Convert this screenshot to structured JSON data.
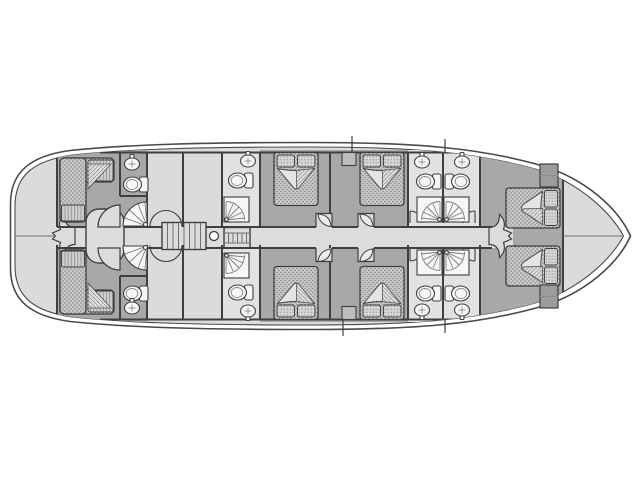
{
  "diagram": {
    "kind": "yacht-lower-deck-floor-plan",
    "orientation": {
      "bow": "right",
      "stern": "left",
      "port_side": "top",
      "starboard_side": "bottom"
    }
  },
  "colors": {
    "background": "#ffffff",
    "hull_ring": "#ffffff",
    "hull_line": "#4a4a4a",
    "interior": "#dbdbdb",
    "cabin_floor": "#a8a8a8",
    "corridor_floor": "#dcdcdc",
    "bathroom_floor": "#e2e2e2",
    "wall_line": "#3f3f3f",
    "fixture_fill": "#f6f6f6",
    "bed_base": "#c8c8c8",
    "wardrobe_fill": "#9c9c9c"
  },
  "rooms": [
    {
      "name": "stern-compartment",
      "type": "storage",
      "fixtures": []
    },
    {
      "name": "aft-cabin-port",
      "type": "cabin",
      "fixtures": [
        "l-shaped-sofa-bed",
        "washbasin",
        "toilet",
        "corner-shower",
        "entry-door"
      ]
    },
    {
      "name": "aft-cabin-starboard",
      "type": "cabin",
      "fixtures": [
        "l-shaped-sofa-bed",
        "washbasin",
        "toilet",
        "corner-shower",
        "entry-door"
      ]
    },
    {
      "name": "companionway",
      "type": "circulation",
      "fixtures": [
        "staircase",
        "steps",
        "mast",
        "double-door-aft",
        "double-door-forward",
        "corridor"
      ]
    },
    {
      "name": "guest-cabin-port-aft",
      "type": "cabin",
      "fixtures": [
        "double-bed",
        "entry-door"
      ]
    },
    {
      "name": "guest-cabin-port-forward",
      "type": "cabin",
      "fixtures": [
        "double-bed",
        "cabinet",
        "entry-door"
      ]
    },
    {
      "name": "guest-cabin-starboard-aft",
      "type": "cabin",
      "fixtures": [
        "double-bed",
        "entry-door"
      ]
    },
    {
      "name": "guest-cabin-starboard-forward",
      "type": "cabin",
      "fixtures": [
        "double-bed",
        "cabinet",
        "entry-door"
      ]
    },
    {
      "name": "bathroom-port-aft",
      "type": "bathroom",
      "fixtures": [
        "washbasin",
        "toilet",
        "shower"
      ]
    },
    {
      "name": "bathroom-starboard-aft",
      "type": "bathroom",
      "fixtures": [
        "washbasin",
        "toilet",
        "shower"
      ]
    },
    {
      "name": "bathroom-port-forward",
      "type": "bathroom",
      "fixtures": [
        "washbasin",
        "toilet",
        "shower"
      ]
    },
    {
      "name": "bathroom-starboard-forward",
      "type": "bathroom",
      "fixtures": [
        "washbasin",
        "toilet",
        "shower"
      ]
    },
    {
      "name": "bow-cabin",
      "type": "cabin",
      "fixtures": [
        "bed-port",
        "bed-starboard",
        "wardrobe-port",
        "wardrobe-starboard",
        "double-door"
      ]
    },
    {
      "name": "bow-peak",
      "type": "void",
      "fixtures": []
    }
  ],
  "fixture_counts": {
    "double_beds": 4,
    "single_beds": 2,
    "l_shaped_sofas": 2,
    "toilets": 8,
    "washbasins": 8,
    "showers": 8,
    "staircases": 2,
    "masts": 1
  }
}
